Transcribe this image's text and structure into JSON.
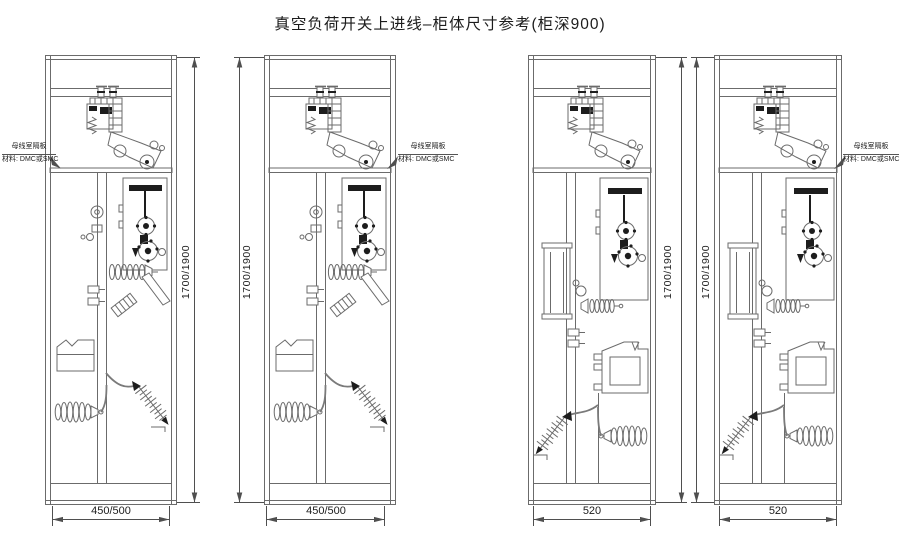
{
  "title": "真空负荷开关上进线–柜体尺寸参考(柜深900)",
  "cabinets": [
    {
      "name": "cabinet-1",
      "height": "1700/1900",
      "width": "450/500"
    },
    {
      "name": "cabinet-2",
      "height": "1700/1900",
      "width": "450/500"
    },
    {
      "name": "cabinet-3",
      "height": "1700/1900",
      "width": "520"
    },
    {
      "name": "cabinet-4",
      "height": "1700/1900",
      "width": "520"
    }
  ],
  "annotation": {
    "line1": "母线室隔板",
    "line2": "材料: DMC或SMC"
  },
  "colors": {
    "line": "#6b6b6b",
    "dark": "#1d1d1d",
    "dim": "#4f4f4f",
    "text": "#1c1c1c",
    "background": "#ffffff"
  }
}
